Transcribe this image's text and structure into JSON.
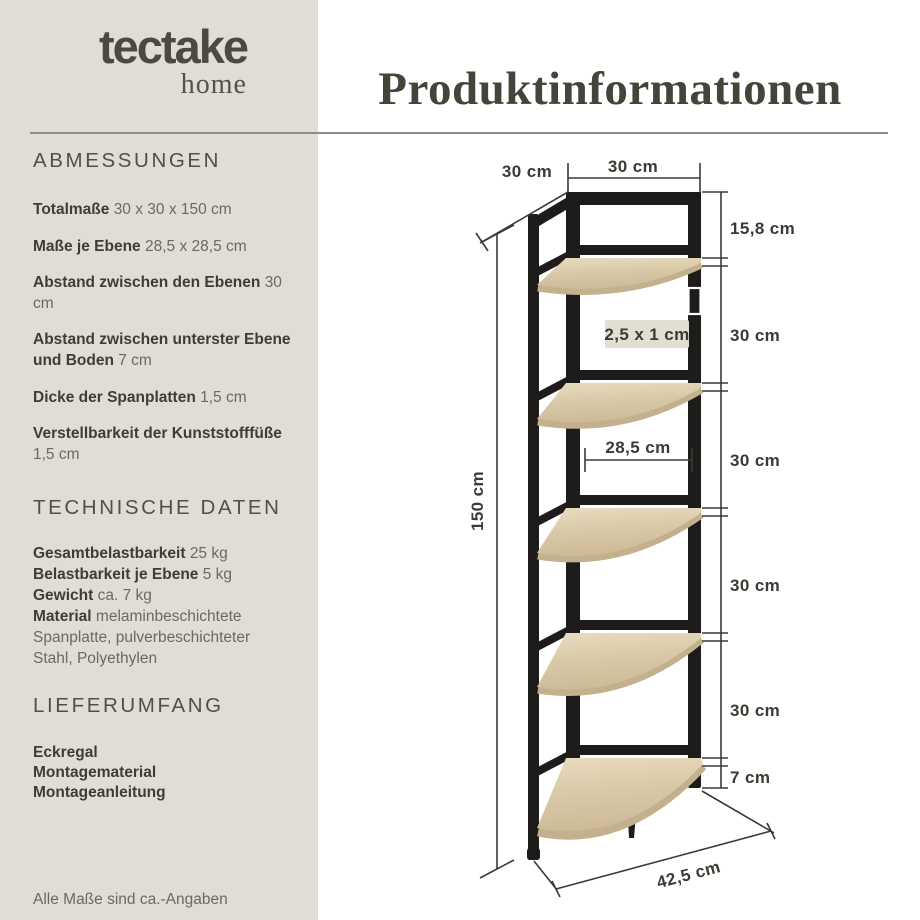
{
  "brand": {
    "name": "tectake",
    "sub": "home"
  },
  "title": "Produktinformationen",
  "sidebar": {
    "sections": [
      {
        "heading": "ABMESSUNGEN",
        "items": [
          {
            "label": "Totalmaße",
            "value": "30 x 30 x 150 cm"
          },
          {
            "label": "Maße je Ebene",
            "value": "28,5 x 28,5 cm"
          },
          {
            "label": "Abstand zwischen den Ebenen",
            "value": "30 cm"
          },
          {
            "label": "Abstand zwischen unterster Ebene und Boden",
            "value": "7 cm"
          },
          {
            "label": "Dicke der Spanplatten",
            "value": "1,5 cm"
          },
          {
            "label": "Verstellbarkeit der Kunststofffüße",
            "value": "1,5 cm"
          }
        ]
      },
      {
        "heading": "TECHNISCHE DATEN",
        "items": [
          {
            "label": "Gesamtbelastbarkeit",
            "value": "25 kg"
          },
          {
            "label": "Belastbarkeit je Ebene",
            "value": "5 kg"
          },
          {
            "label": "Gewicht",
            "value": "ca. 7 kg"
          },
          {
            "label": "Material",
            "value": "melaminbeschichtete Spanplatte, pulverbeschichteter Stahl, Polyethylen"
          }
        ]
      },
      {
        "heading": "LIEFERUMFANG",
        "items": [
          {
            "label": "Eckregal"
          },
          {
            "label": "Montagematerial"
          },
          {
            "label": "Montageanleitung"
          }
        ]
      }
    ],
    "note": "Alle Maße sind ca.-Angaben"
  },
  "diagram": {
    "top_depth": "30 cm",
    "top_width": "30 cm",
    "height": "150 cm",
    "right_labels": [
      "15,8 cm",
      "30 cm",
      "30 cm",
      "30 cm",
      "30 cm",
      "7 cm"
    ],
    "shelf_width": "28,5 cm",
    "profile": "2,5 x 1 cm",
    "diagonal": "42,5 cm"
  },
  "colors": {
    "sidebar_bg": "#E0DDD4",
    "frame": "#1D1C1A",
    "wood": "#D8C8A7",
    "text_dark": "#3E3D34",
    "text_muted": "#6A6A5F"
  }
}
